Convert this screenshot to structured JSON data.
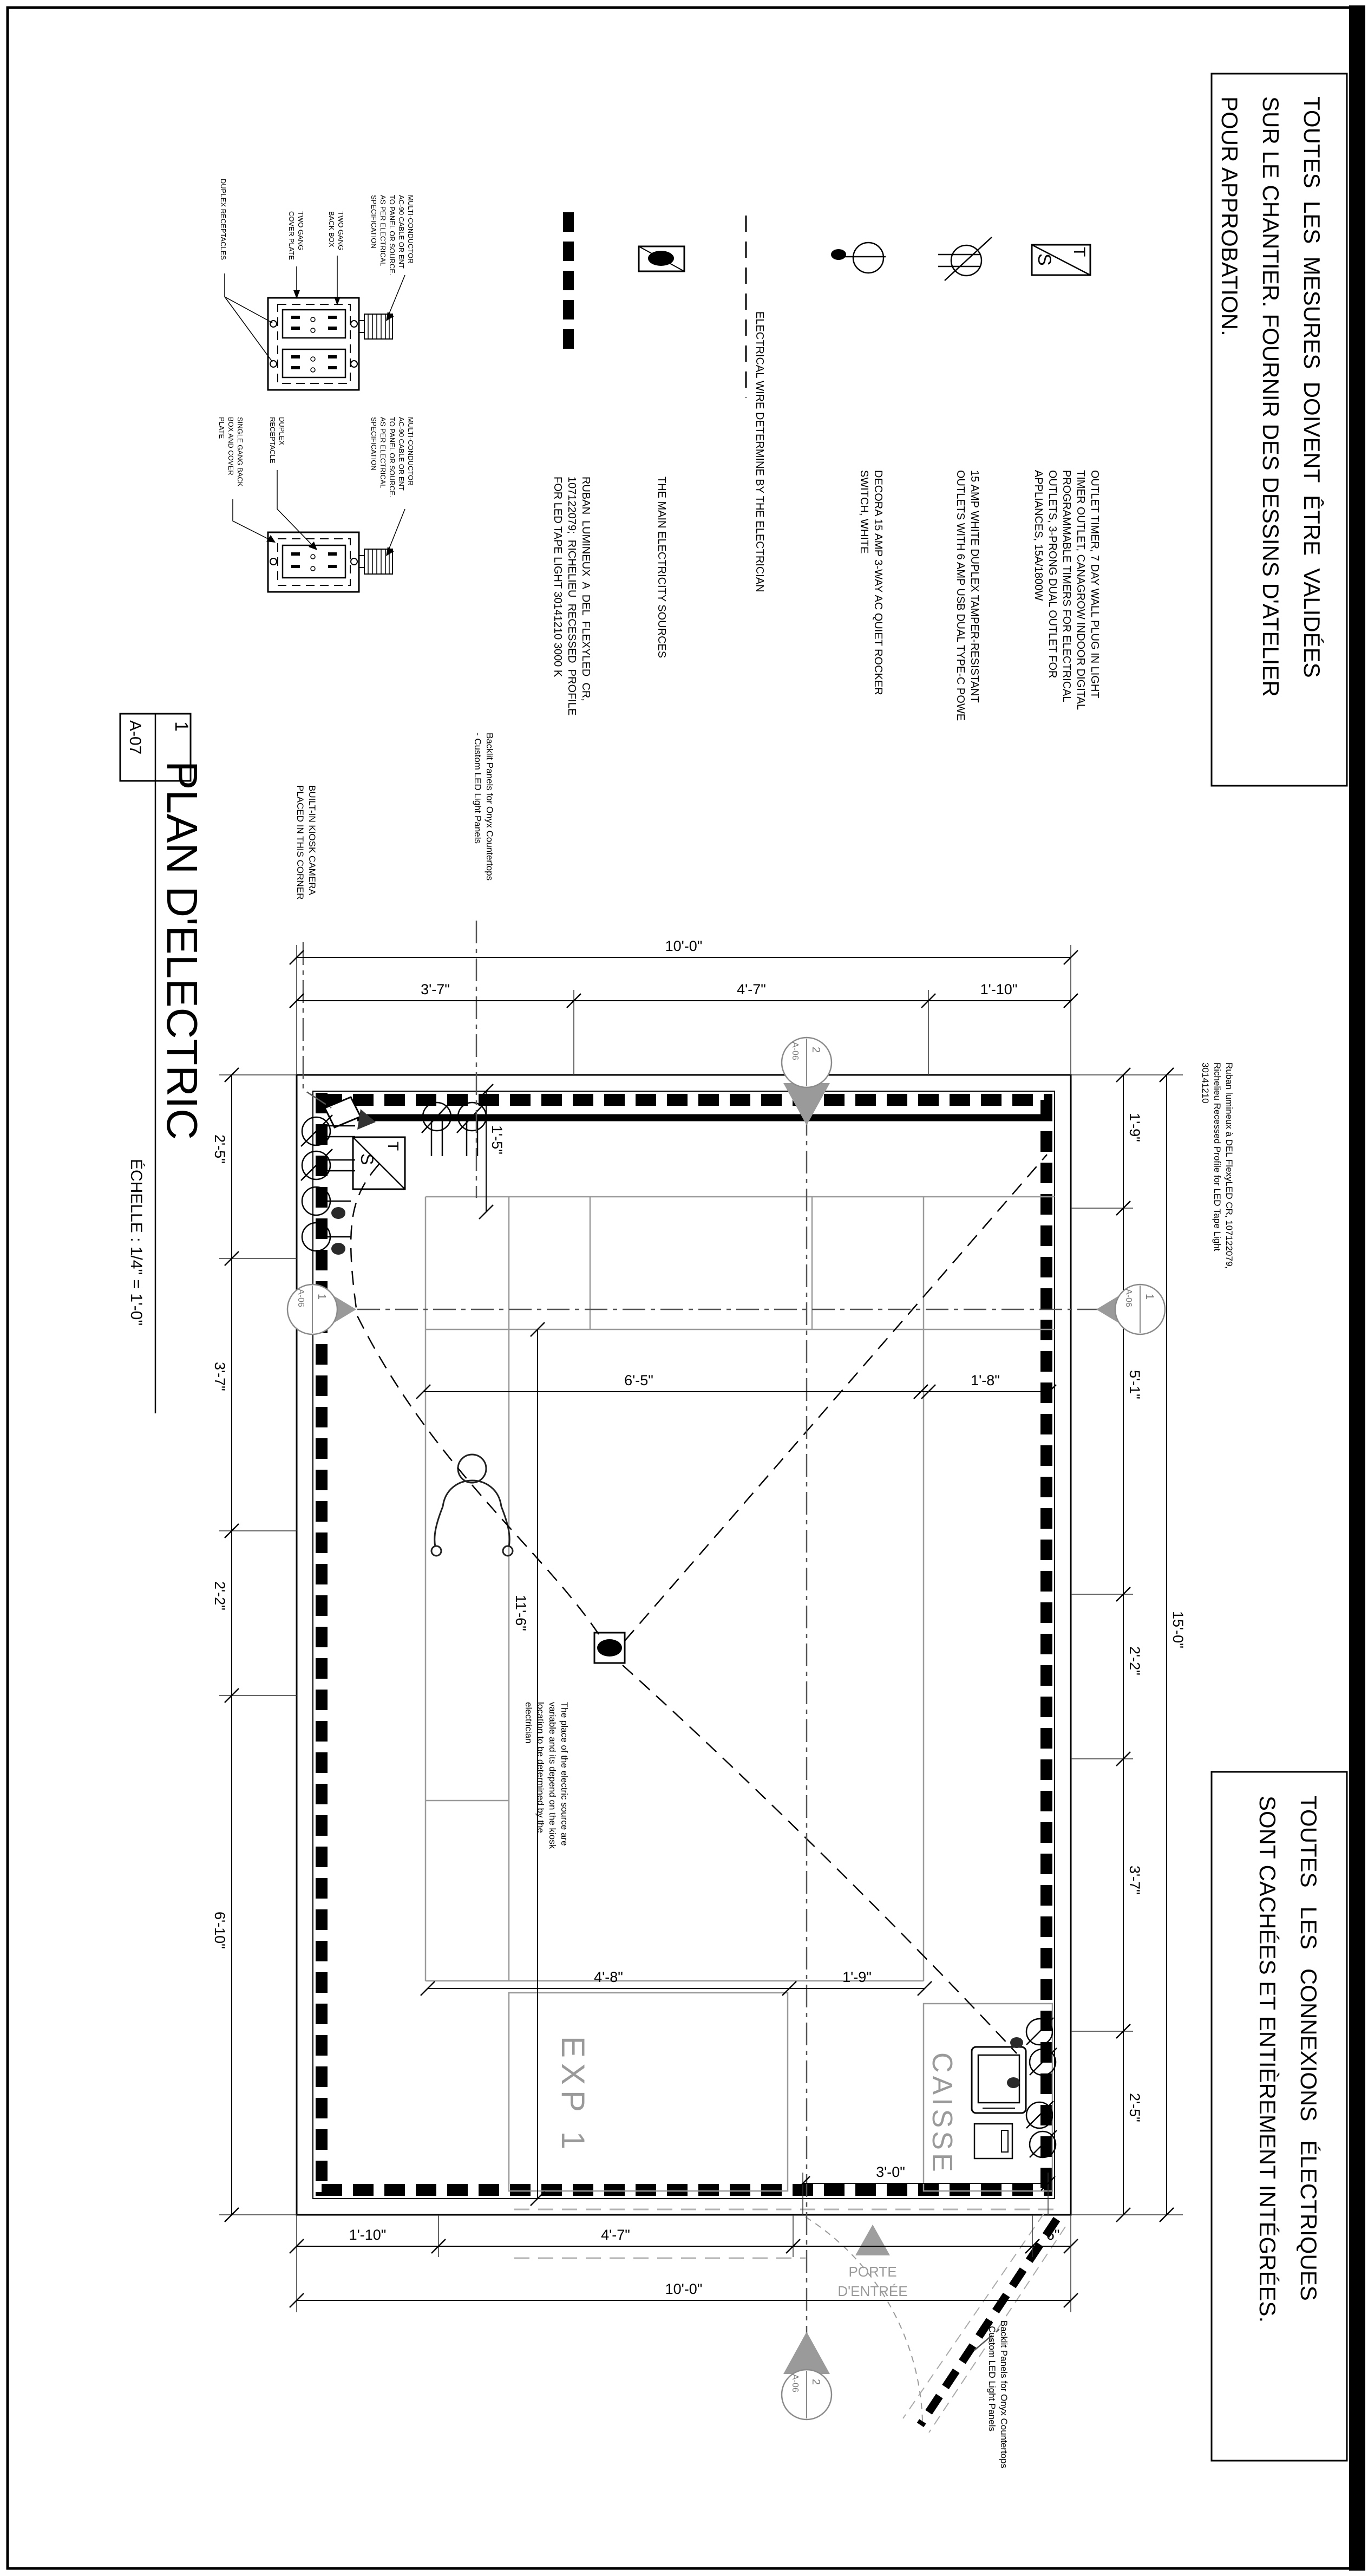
{
  "colors": {
    "line": "#000000",
    "gray_label": "#9a9a9a",
    "gray_line": "#999999",
    "light_line": "#bbbbbb"
  },
  "titleblock": {
    "detail_number": "1",
    "sheet_ref": "A-07",
    "title": "PLAN D'ELECTRIC",
    "scale": "ÉCHELLE : 1/4\" = 1'-0\""
  },
  "boxed_notes": {
    "top": {
      "line1": "TOUTES  LES  MESURES  DOIVENT  ÊTRE  VALIDÉES",
      "line2": "SUR LE CHANTIER. FOURNIR DES DESSINS D'ATELIER",
      "line3": "POUR APPROBATION."
    },
    "bottom": {
      "line1": "TOUTES   LES   CONNEXIONS   ÉLECTRIQUES",
      "line2": "SONT CACHÉES ET ENTIÈREMENT INTÉGRÉES."
    }
  },
  "legend": {
    "timer": {
      "letters": {
        "t": "T",
        "s": "S"
      },
      "line1": "OUTLET TIMER, 7 DAY WALL PLUG IN LIGHT",
      "line2": "TIMER OUTLET, CANAGROW INDOOR DIGITAL",
      "line3": "PROGRAMMABLE TIMERS FOR ELECTRICAL",
      "line4": "OUTLETS, 3-PRONG DUAL OUTLET FOR",
      "line5": "APPLIANCES, 15A/1800W"
    },
    "outlet": {
      "line1": "15 AMP WHITE DUPLEX TAMPER-RESISTANT",
      "line2": "OUTLETS WITH 6 AMP USB DUAL TYPE-C POWE"
    },
    "switch": {
      "line1": "DECORA 15 AMP 3-WAY AC QUIET ROCKER",
      "line2": "SWITCH, WHITE"
    },
    "wire": {
      "line1": "ELECTRICAL WIRE DETERMINE BY THE ELECTRICIAN"
    },
    "source": {
      "line1": "THE MAIN ELECTRICITY SOURCES"
    },
    "ruban": {
      "line1": "RUBAN  LUMINEUX  A  DEL  FLEXYLED  CR,",
      "line2": "107122079;  RICHELIEU  RECESSED  PROFILE",
      "line3": "FOR LED TAPE LIGHT 30141210 3000 K"
    }
  },
  "details": {
    "two_gang": {
      "label": "DUPLEX RECEPTACLES",
      "cover1": "TWO GANG",
      "cover2": "COVER PLATE",
      "box1": "TWO GANG",
      "box2": "BACK BOX",
      "cable1": "MULTI-CONDUCTOR",
      "cable2": "AC-90 CABLE OR ENT",
      "cable3": "TO PANEL OR SOURCE.",
      "cable4": "AS PER ELECTRICAL",
      "cable5": "SPECIFICATION"
    },
    "single_gang": {
      "label1": "DUPLEX",
      "label2": "RECEPTACLE",
      "box1": "SINGLE GANG BACK",
      "box2": "BOX AND COVER",
      "box3": "PLATE",
      "cable1": "MULTI-CONDUCTOR",
      "cable2": "AC-90 CABLE OR ENT",
      "cable3": "TO PANEL OR SOURCE.",
      "cable4": "AS PER ELECTRICAL",
      "cable5": "SPECIFICATION"
    }
  },
  "plan_notes": {
    "camera1": "BUILT-IN KIOSK CAMERA",
    "camera2": "PLACED IN THIS CORNER",
    "backlit_top1": "Backlit Panels for Onyx Countertops",
    "backlit_top2": "- Custom LED Light Panels",
    "backlit_bottom1": "Backlit Panels for Onyx Countertops",
    "backlit_bottom2": "- Custom LED Light Panels",
    "ruban1": "Ruban lumineux à DEL FlexyLED CR, 107122079,",
    "ruban2": "Richelieu Recessed Profile for LED Tape Light",
    "ruban3": "30141210",
    "source1": "The place of the electric source are",
    "source2": "variable and its depend on the kiosk",
    "source3": "location to be determined by the",
    "source4": "electrician",
    "door1": "PORTE",
    "door2": "D'ENTRÉE",
    "room_exp": "EXP 1",
    "room_caisse": "CAISSE"
  },
  "dims": {
    "top_overall": "10'-0\"",
    "top_seg1": "3'-7\"",
    "top_seg2": "4'-7\"",
    "top_seg3": "1'-10\"",
    "bottom_seg1": "1'-10\"",
    "bottom_seg2": "4'-7\"",
    "bottom_seg3": "6\"",
    "bottom_overall": "10'-0\"",
    "door_width": "3'-0\"",
    "left_seg1": "2'-5\"",
    "left_seg2": "3'-7\"",
    "left_seg3": "2'-2\"",
    "left_seg4": "6'-10\"",
    "right_seg1": "1'-9\"",
    "right_seg2": "5'-1\"",
    "right_seg3": "2'-2\"",
    "right_seg4": "3'-7\"",
    "right_seg5": "2'-5\"",
    "right_overall": "15'-0\"",
    "counter_depth": "1'-5\"",
    "floor_width": "6'-5\"",
    "floor_to_wall": "1'-8\"",
    "room_length": "11'-6\"",
    "exp_width": "4'-8\"",
    "exp_gap": "1'-9\""
  },
  "markers": {
    "top": {
      "num": "2",
      "sheet": "A-06"
    },
    "bottom": {
      "num": "2",
      "sheet": "A-06"
    },
    "left": {
      "num": "1",
      "sheet": "A-06"
    },
    "right": {
      "num": "1",
      "sheet": "A-06"
    }
  }
}
